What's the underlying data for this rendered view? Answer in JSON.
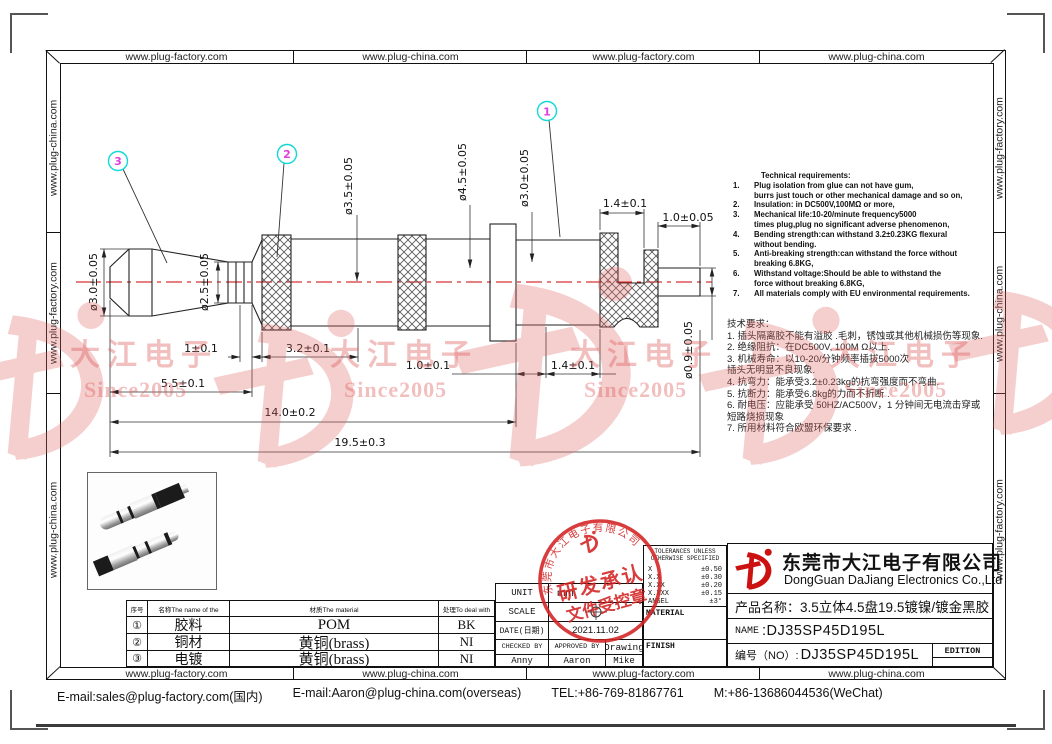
{
  "border_urls": {
    "top": [
      "www.plug-factory.com",
      "www.plug-china.com",
      "www.plug-factory.com",
      "www.plug-china.com"
    ],
    "bottom": [
      "www.plug-factory.com",
      "www.plug-china.com",
      "www.plug-factory.com",
      "www.plug-china.com"
    ],
    "left": [
      "www.plug-china.com",
      "www.plug-factory.com",
      "www.plug-china.com"
    ],
    "right": [
      "www.plug-factory.com",
      "www.plug-china.com",
      "www.plug-factory.com"
    ]
  },
  "footer": {
    "email_domestic": "E-mail:sales@plug-factory.com(国内)",
    "email_overseas": "E-mail:Aaron@plug-china.com(overseas)",
    "tel": "TEL:+86-769-81867761",
    "mobile": "M:+86-13686044536(WeChat)"
  },
  "drawing": {
    "balloons": [
      "1",
      "2",
      "3"
    ],
    "dims": {
      "dia30_left": "ø3.0±0.05",
      "dia25": "ø2.5±0.05",
      "dia35": "ø3.5±0.05",
      "dia45": "ø4.5±0.05",
      "dia30_right": "ø3.0±0.05",
      "dia09": "ø0.9±0.05",
      "len14_top": "1.4±0.1",
      "len10_top": "1.0±0.05",
      "len1": "1±0.1",
      "len32": "3.2±0.1",
      "len55": "5.5±0.1",
      "len10_bot": "1.0±0.1",
      "len14_bot": "1.4±0.1",
      "len140": "14.0±0.2",
      "len195": "19.5±0.3"
    }
  },
  "tech_req_en": {
    "title": "Technical requirements:",
    "lines": [
      {
        "num": "1.",
        "text": "Plug isolation from glue can not have gum,"
      },
      {
        "num": "",
        "text": "burrs just touch or other mechanical damage and so on,"
      },
      {
        "num": "2.",
        "text": "Insulation: in DC500V,100MΩ or more,"
      },
      {
        "num": "3.",
        "text": "Mechanical life:10-20/minute frequency5000"
      },
      {
        "num": "",
        "text": "times plug,plug no significant adverse phenomenon,"
      },
      {
        "num": "4.",
        "text": "Bending strength:can withstand 3.2±0.23KG flexural"
      },
      {
        "num": "",
        "text": "without bending."
      },
      {
        "num": "5.",
        "text": "Anti-breaking strength:can withstand the force without"
      },
      {
        "num": "",
        "text": "breaking 6.8KG,"
      },
      {
        "num": "6.",
        "text": "Withstand voltage:Should be able to withstand the"
      },
      {
        "num": "",
        "text": "force without breaking 6.8KG,"
      },
      {
        "num": "7.",
        "text": "All materials comply with EU environmental requirements."
      }
    ]
  },
  "tech_req_cn": {
    "title": "技术要求：",
    "lines": [
      "1. 插头隔离胶不能有溢胶 .毛刺，锈蚀或其他机械损伤等现象.",
      "2. 绝缘阻抗：在DC500V, 100M Ω以上.",
      "3. 机械寿命：以10-20/分钟频率插拔5000次",
      "插头无明显不良现象.",
      "4. 抗弯力：能承受3.2±0.23kg的抗弯强度而不弯曲.",
      "5. 抗断力：能承受6.8kg的力而不折断 .",
      "6. 耐电压：应能承受 50HZ/AC500V，1 分钟间无电流击穿或",
      "短路烧损现象",
      "7. 所用材料符合欧盟环保要求 ."
    ]
  },
  "materials": {
    "headers": {
      "no": "序号",
      "name": "名称The name of the",
      "material": "材质The material",
      "treat": "处理To deal with"
    },
    "rows": [
      {
        "no": "①",
        "name": "胶料",
        "material": "POM",
        "treat": "BK"
      },
      {
        "no": "②",
        "name": "铜材",
        "material": "黄铜(brass)",
        "treat": "NI"
      },
      {
        "no": "③",
        "name": "电镀",
        "material": "黄铜(brass)",
        "treat": "NI"
      }
    ]
  },
  "info_block": {
    "unit_label": "UNIT",
    "unit_value": "mm",
    "scale_label": "SCALE",
    "date_label": "DATE(日期)",
    "date_value": "2021.11.02",
    "checked_label": "CHECKED BY",
    "approved_label": "APPROVED BY",
    "drawing_label": "Drawing",
    "checked_name": "Anny",
    "approved_name": "Aaron",
    "drawing_name": "Mike"
  },
  "tolerances": {
    "header": "TOLERANCES UNLESS OTHERWISE SPECIFIED",
    "rows": [
      {
        "g": "X",
        "v": "±0.50"
      },
      {
        "g": "X.X",
        "v": "±0.30"
      },
      {
        "g": "X.XX",
        "v": "±0.20"
      },
      {
        "g": "X.XXX",
        "v": "±0.15"
      },
      {
        "g": "ANGEL",
        "v": "±3°"
      }
    ],
    "material_label": "MATERIAL",
    "finish_label": "FINISH"
  },
  "company": {
    "name_cn": "东莞市大江电子有限公司",
    "name_en": "DongGuan DaJiang Electronics Co.,Ltd",
    "product_label": "产品名称：",
    "product_value": "3.5立体4.5盘19.5镀镍/镀金黑胶",
    "name_label": "NAME",
    "name_value": ":DJ35SP45D195L",
    "no_label": "编号（NO）:",
    "no_value": "DJ35SP45D195L",
    "edition_label": "EDITION"
  },
  "stamp": {
    "arc_text": "东莞市大江电子有限公司",
    "line1": "研发承认",
    "line2": "文件受控章"
  },
  "watermark": {
    "brand": "大江电子",
    "since": "Since2005"
  },
  "colors": {
    "stamp_red": "#d32222",
    "logo_red": "#cc1111",
    "watermark_pink": "#e06060",
    "centerline_red": "#cc0000",
    "balloon_ring": "#12d8d8",
    "balloon_number": "#e23ee2"
  }
}
